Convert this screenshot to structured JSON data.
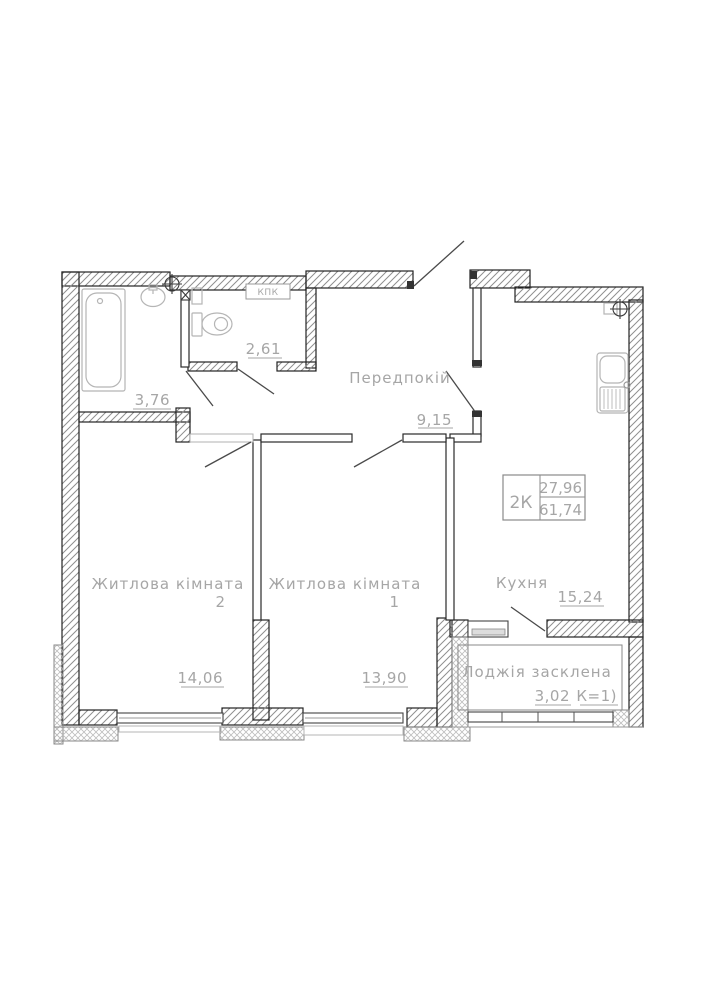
{
  "plan": {
    "info_box": {
      "type_label": "2К",
      "living_area": "27,96",
      "total_area": "61,74"
    },
    "rooms": {
      "hallway": {
        "name": "Передпокій",
        "area": "9,15"
      },
      "bathroom": {
        "area": "3,76"
      },
      "wc": {
        "area": "2,61"
      },
      "kitchen": {
        "name": "Кухня",
        "area": "15,24"
      },
      "room1": {
        "name": "Житлова кімната",
        "number": "1",
        "area": "13,90"
      },
      "room2": {
        "name": "Житлова кімната",
        "number": "2",
        "area": "14,06"
      },
      "loggia": {
        "name": "Лоджія засклена",
        "area": "3,02",
        "coef": "К=1)"
      }
    },
    "annotations": {
      "duct_label": "КПК"
    },
    "colors": {
      "wall_line": "#222222",
      "hatch": "#8f8f8f",
      "light_hatch": "#bdbdbd",
      "text": "#a6a6a6",
      "fixture": "#b5b5b5",
      "background": "#ffffff"
    }
  }
}
